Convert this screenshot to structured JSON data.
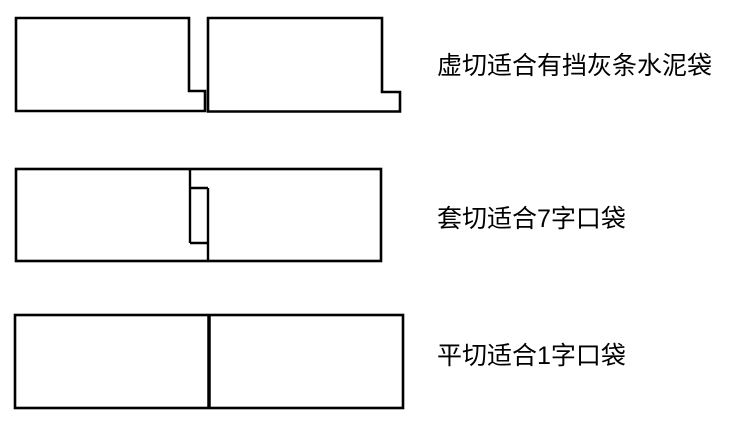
{
  "canvas": {
    "background": "#ffffff",
    "line_color": "#000000",
    "text_color": "#000000"
  },
  "rows": [
    {
      "id": "dashed-cut",
      "diagram": "two rectangles, each with a small step foot at bottom-right, interlocking with a narrow gap",
      "label": "虚切适合有挡灰条水泥袋"
    },
    {
      "id": "sleeve-cut",
      "diagram": "one long rectangle with a 7-shaped interlocking cut and small tab in the middle",
      "label": "套切适合7字口袋"
    },
    {
      "id": "flat-cut",
      "diagram": "one long rectangle split by a single straight vertical cut in the middle",
      "label": "平切适合1字口袋"
    }
  ]
}
